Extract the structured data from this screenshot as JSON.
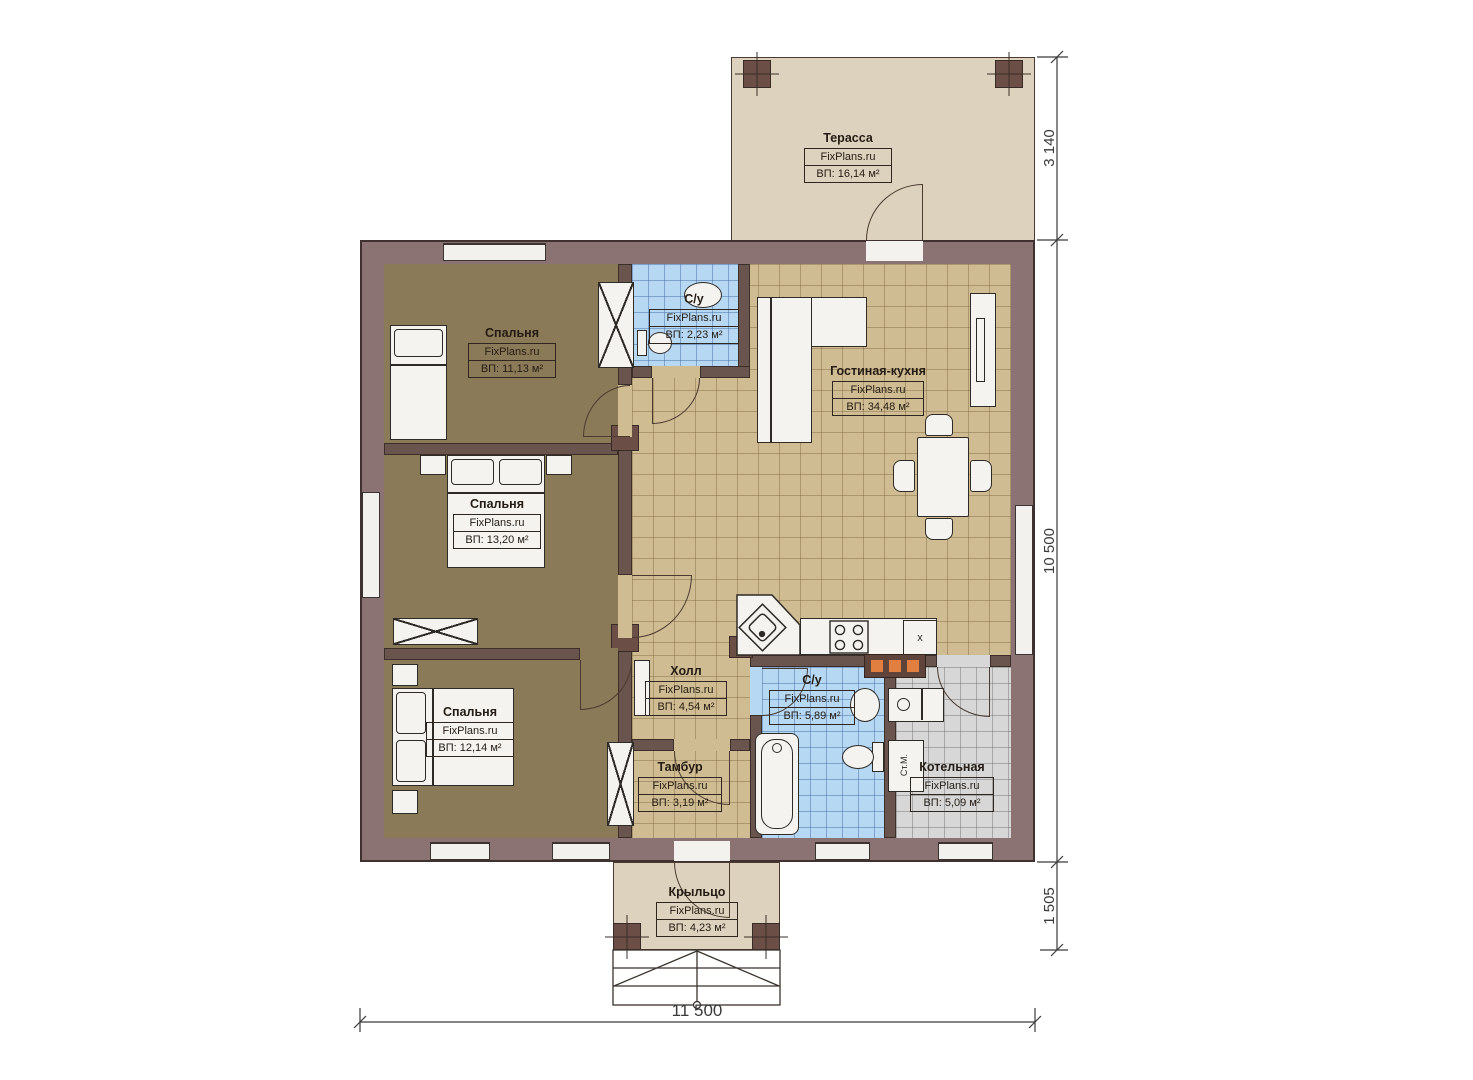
{
  "watermark": "FixPlans.ru",
  "rooms": {
    "terrace": {
      "name": "Терасса",
      "area": "ВП: 16,14 м²"
    },
    "bedroom1": {
      "name": "Спальня",
      "area": "ВП: 11,13 м²"
    },
    "bedroom2": {
      "name": "Спальня",
      "area": "ВП: 13,20 м²"
    },
    "bedroom3": {
      "name": "Спальня",
      "area": "ВП: 12,14 м²"
    },
    "wc_top": {
      "name": "С/у",
      "area": "ВП: 2,23 м²"
    },
    "living": {
      "name": "Гостиная-кухня",
      "area": "ВП: 34,48 м²"
    },
    "hall": {
      "name": "Холл",
      "area": "ВП: 4,54 м²"
    },
    "tambour": {
      "name": "Тамбур",
      "area": "ВП: 3,19 м²"
    },
    "bath": {
      "name": "С/у",
      "area": "ВП: 5,89 м²"
    },
    "boiler": {
      "name": "Котельная",
      "area": "ВП: 5,09 м²"
    },
    "porch": {
      "name": "Крыльцо",
      "area": "ВП: 4,23 м²"
    }
  },
  "dimensions": {
    "terrace_depth": "3 140",
    "house_depth": "10 500",
    "porch_depth": "1 505",
    "house_width": "11 500"
  },
  "marks": {
    "washer": "Ст.М.",
    "kitchen_x": "x"
  },
  "colors": {
    "wall": "#8b7373",
    "interior_wall": "#6a544e",
    "bedroom_floor": "#8b7a58",
    "tile_floor": "#cfbc92",
    "wet_floor": "#b7d8f3",
    "utility_floor": "#d7d7d7",
    "deck_floor": "#ddd2bd",
    "accent_orange": "#e07f3f"
  }
}
